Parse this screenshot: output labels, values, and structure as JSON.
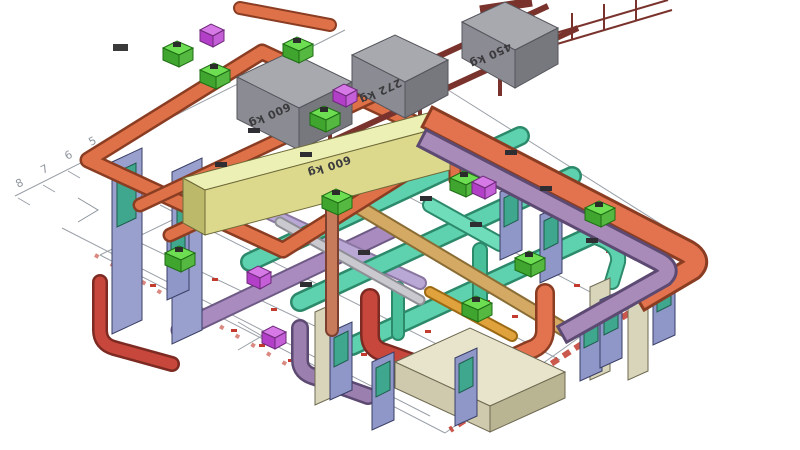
{
  "view": {
    "name": "3D BIM coordination model",
    "description": "Isometric CAD view of a mechanical plant room showing MEP services: piping loops, round and rectangular ductwork, equipment, wall and door panels over a 2D floor-plan underlay"
  },
  "grid": {
    "labels": [
      "8",
      "7",
      "6",
      "5"
    ]
  },
  "equipment_weights": {
    "box_600": "600 kg",
    "box_272": "272 kg",
    "box_450": "450 kg",
    "silencer_600": "600 kg"
  },
  "colors": {
    "pipe_orange": "#df7148",
    "duct_orange": "#e2734e",
    "duct_purple": "#a98bb9",
    "duct_teal": "#5ed1ae",
    "duct_teal_dark": "#2c8a6b",
    "steel_maroon": "#7a332c",
    "equipment_gray": "#9fa0a6",
    "silencer_yellow": "#e0dc96",
    "pump_green": "#54c43e",
    "valve_magenta": "#c45fd8",
    "wall_blue": "#8f96c8",
    "window_teal": "#3fa78e",
    "annotation_red": "#c23b2e",
    "plan_gray": "#9aa0a8",
    "column_beige": "#d9d5ba"
  }
}
